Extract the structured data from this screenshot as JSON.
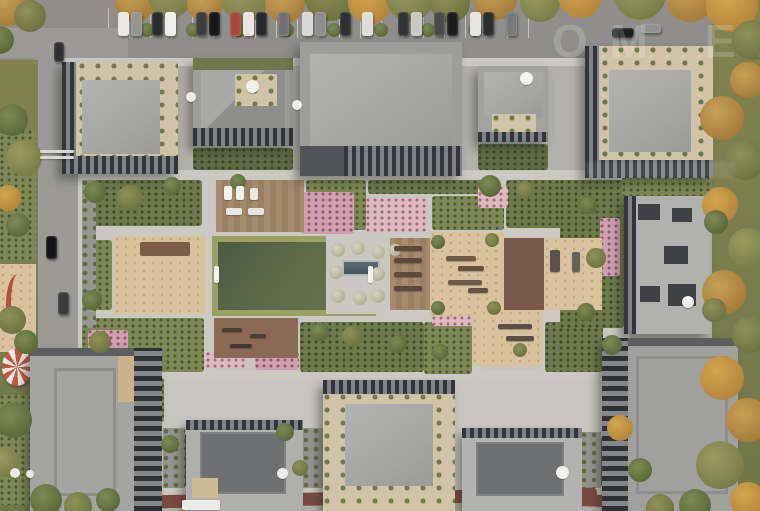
{
  "meta": {
    "subject": "aerial top-down architectural render of a residential complex with landscaped courtyard",
    "watermark_note": "faint translucent site watermark, partially legible"
  },
  "watermark": {
    "line1": "ОМ ЕА"
  },
  "palette": {
    "asphalt": "#8f8e8b",
    "road": "#9b9a97",
    "paving": "#c8c6c0",
    "path": "#cbc9c4",
    "roof_light": "#a8a8a6",
    "roof_dark": "#6e7072",
    "facade_dark": "#33353a",
    "gravel": "#d1c3a7",
    "sand": "#d8c39e",
    "deck": "#a68a6c",
    "rubber": "#7a5b4b",
    "field_green": "#55634a",
    "hedge": "#9aa164",
    "pool_blue": "#4d5d68",
    "track_red": "#7c4a42",
    "play_red": "#c05840",
    "trees": {
      "autumn": [
        "#c9a055",
        "#9a6f33"
      ],
      "autumn2": [
        "#d2a74e",
        "#a87a36"
      ],
      "olive": [
        "#9c9c60",
        "#6f7240"
      ],
      "olive2": [
        "#8f9158",
        "#626a38"
      ],
      "green": [
        "#7d8b52",
        "#4f5d33"
      ],
      "pale": [
        "#d6d2bc",
        "#a9a58c"
      ]
    },
    "beds": {
      "g1": [
        "#6e7a4c",
        "#3f4a2b"
      ],
      "g2": [
        "#7e8955",
        "#4c5631"
      ],
      "g3": [
        "#5a6740",
        "#37422a"
      ],
      "pink": [
        "#cfa0af",
        "#8f5a6b"
      ],
      "pink2": [
        "#ddb9c3",
        "#a06b7a"
      ],
      "hedge": [
        "#5f6b42",
        "#39452a"
      ]
    }
  },
  "scene": {
    "paths": [
      [
        80,
        171,
        548,
        8
      ],
      [
        80,
        225,
        548,
        14
      ],
      [
        80,
        308,
        548,
        13
      ],
      [
        84,
        370,
        540,
        10
      ],
      [
        78,
        171,
        10,
        330
      ],
      [
        202,
        175,
        13,
        200
      ],
      [
        318,
        175,
        12,
        200
      ],
      [
        428,
        175,
        14,
        200
      ],
      [
        540,
        175,
        13,
        200
      ],
      [
        608,
        171,
        14,
        262
      ],
      [
        300,
        308,
        11,
        75
      ],
      [
        470,
        308,
        11,
        75
      ],
      [
        160,
        238,
        9,
        135
      ],
      [
        84,
        480,
        530,
        10
      ],
      [
        62,
        58,
        600,
        8
      ]
    ],
    "beds": [
      [
        84,
        180,
        118,
        46,
        "g1"
      ],
      [
        306,
        180,
        60,
        50,
        "g2"
      ],
      [
        368,
        180,
        118,
        14,
        "g1"
      ],
      [
        432,
        196,
        72,
        34,
        "g2"
      ],
      [
        506,
        180,
        100,
        48,
        "g1"
      ],
      [
        560,
        196,
        44,
        32,
        "pink"
      ],
      [
        366,
        198,
        60,
        34,
        "pink2"
      ],
      [
        300,
        192,
        54,
        42,
        "pink"
      ],
      [
        84,
        240,
        28,
        70,
        "g2"
      ],
      [
        82,
        318,
        122,
        54,
        "g2"
      ],
      [
        300,
        322,
        124,
        50,
        "g1"
      ],
      [
        424,
        322,
        48,
        52,
        "g2"
      ],
      [
        545,
        322,
        58,
        50,
        "g1"
      ],
      [
        600,
        238,
        26,
        78,
        "g2"
      ],
      [
        560,
        180,
        64,
        148,
        "g1"
      ],
      [
        622,
        176,
        90,
        20,
        "g2"
      ],
      [
        163,
        434,
        24,
        52,
        "g3"
      ],
      [
        305,
        434,
        18,
        52,
        "g3"
      ],
      [
        583,
        438,
        20,
        48,
        "g3"
      ],
      [
        84,
        378,
        80,
        44,
        "g2"
      ],
      [
        0,
        130,
        36,
        130,
        "g2"
      ],
      [
        0,
        395,
        30,
        110,
        "g2"
      ],
      [
        255,
        352,
        44,
        18,
        "pink"
      ],
      [
        432,
        316,
        42,
        10,
        "pink2"
      ],
      [
        470,
        278,
        18,
        30,
        "pink"
      ],
      [
        545,
        248,
        16,
        56,
        "pink2"
      ],
      [
        600,
        218,
        20,
        58,
        "pink"
      ],
      [
        308,
        162,
        46,
        12,
        "pink"
      ],
      [
        478,
        186,
        30,
        22,
        "pink2"
      ],
      [
        206,
        352,
        40,
        16,
        "pink2"
      ],
      [
        88,
        330,
        40,
        20,
        "pink"
      ],
      [
        193,
        148,
        100,
        22,
        "hedge"
      ],
      [
        478,
        144,
        70,
        26,
        "hedge"
      ]
    ],
    "walls": [
      [
        82,
        180,
        14,
        148
      ],
      [
        303,
        428,
        20,
        60
      ],
      [
        581,
        432,
        20,
        56
      ],
      [
        163,
        428,
        22,
        60
      ]
    ],
    "trees": [
      [
        135,
        2,
        20,
        "autumn"
      ],
      [
        170,
        -4,
        22,
        "olive"
      ],
      [
        205,
        4,
        18,
        "autumn"
      ],
      [
        245,
        -2,
        24,
        "olive"
      ],
      [
        285,
        3,
        20,
        "autumn"
      ],
      [
        330,
        -5,
        26,
        "olive2"
      ],
      [
        370,
        2,
        22,
        "autumn2"
      ],
      [
        410,
        -3,
        24,
        "olive"
      ],
      [
        450,
        3,
        20,
        "olive2"
      ],
      [
        495,
        -2,
        22,
        "autumn"
      ],
      [
        540,
        2,
        20,
        "olive"
      ],
      [
        580,
        -4,
        22,
        "autumn2"
      ],
      [
        640,
        -6,
        26,
        "olive"
      ],
      [
        690,
        -2,
        24,
        "autumn"
      ],
      [
        732,
        6,
        26,
        "autumn2"
      ],
      [
        752,
        40,
        20,
        "olive2"
      ],
      [
        748,
        80,
        18,
        "autumn"
      ],
      [
        147,
        30,
        7,
        "green"
      ],
      [
        193,
        30,
        7,
        "green"
      ],
      [
        240,
        30,
        7,
        "green"
      ],
      [
        287,
        30,
        7,
        "green"
      ],
      [
        334,
        30,
        7,
        "green"
      ],
      [
        381,
        30,
        7,
        "green"
      ],
      [
        428,
        30,
        7,
        "green"
      ],
      [
        475,
        30,
        7,
        "green"
      ],
      [
        8,
        6,
        20,
        "autumn"
      ],
      [
        30,
        16,
        16,
        "olive2"
      ],
      [
        0,
        40,
        14,
        "green"
      ],
      [
        12,
        120,
        16,
        "green"
      ],
      [
        24,
        158,
        18,
        "olive"
      ],
      [
        8,
        198,
        13,
        "autumn2"
      ],
      [
        18,
        225,
        12,
        "green"
      ],
      [
        12,
        320,
        14,
        "olive2"
      ],
      [
        26,
        342,
        12,
        "green"
      ],
      [
        14,
        420,
        18,
        "green"
      ],
      [
        4,
        462,
        15,
        "olive"
      ],
      [
        46,
        500,
        16,
        "green"
      ],
      [
        78,
        506,
        14,
        "olive2"
      ],
      [
        108,
        500,
        12,
        "green"
      ],
      [
        722,
        118,
        22,
        "autumn"
      ],
      [
        745,
        160,
        20,
        "olive2"
      ],
      [
        720,
        205,
        18,
        "autumn2"
      ],
      [
        748,
        248,
        20,
        "olive"
      ],
      [
        724,
        292,
        22,
        "autumn"
      ],
      [
        750,
        335,
        18,
        "olive2"
      ],
      [
        722,
        378,
        22,
        "autumn2"
      ],
      [
        748,
        420,
        22,
        "autumn"
      ],
      [
        720,
        465,
        24,
        "olive"
      ],
      [
        748,
        500,
        18,
        "autumn2"
      ],
      [
        695,
        505,
        16,
        "green"
      ],
      [
        660,
        508,
        14,
        "olive2"
      ],
      [
        716,
        222,
        12,
        "green"
      ],
      [
        714,
        310,
        12,
        "olive2"
      ],
      [
        95,
        192,
        11,
        "green"
      ],
      [
        130,
        198,
        13,
        "olive2"
      ],
      [
        172,
        186,
        9,
        "green"
      ],
      [
        238,
        182,
        8,
        "green"
      ],
      [
        490,
        186,
        11,
        "green"
      ],
      [
        525,
        190,
        9,
        "olive2"
      ],
      [
        92,
        300,
        10,
        "green"
      ],
      [
        100,
        342,
        11,
        "olive2"
      ],
      [
        320,
        332,
        9,
        "green"
      ],
      [
        352,
        336,
        10,
        "olive2"
      ],
      [
        398,
        344,
        9,
        "green"
      ],
      [
        588,
        205,
        9,
        "green"
      ],
      [
        596,
        258,
        10,
        "olive2"
      ],
      [
        586,
        312,
        9,
        "green"
      ],
      [
        612,
        345,
        10,
        "green"
      ],
      [
        285,
        432,
        9,
        "green"
      ],
      [
        300,
        468,
        8,
        "olive2"
      ],
      [
        170,
        444,
        9,
        "green"
      ],
      [
        620,
        428,
        13,
        "autumn2"
      ],
      [
        640,
        470,
        12,
        "green"
      ],
      [
        440,
        352,
        8,
        "green"
      ],
      [
        520,
        350,
        7,
        "olive2"
      ],
      [
        338,
        250,
        7,
        "pale"
      ],
      [
        358,
        248,
        7,
        "pale"
      ],
      [
        378,
        252,
        7,
        "pale"
      ],
      [
        336,
        272,
        7,
        "pale"
      ],
      [
        378,
        274,
        7,
        "pale"
      ],
      [
        338,
        296,
        7,
        "pale"
      ],
      [
        360,
        298,
        7,
        "pale"
      ],
      [
        378,
        296,
        7,
        "pale"
      ],
      [
        395,
        250,
        6,
        "pale"
      ],
      [
        438,
        242,
        7,
        "green"
      ],
      [
        492,
        240,
        7,
        "olive2"
      ],
      [
        438,
        308,
        7,
        "green"
      ],
      [
        494,
        308,
        7,
        "olive2"
      ]
    ],
    "cars": [
      [
        118,
        12,
        11,
        24,
        "#e9e8e4"
      ],
      [
        131,
        12,
        11,
        24,
        "#95948f"
      ],
      [
        152,
        12,
        11,
        24,
        "#2b2c2e"
      ],
      [
        165,
        12,
        11,
        24,
        "#f0efeb"
      ],
      [
        196,
        12,
        11,
        24,
        "#3c3d3f"
      ],
      [
        209,
        12,
        11,
        24,
        "#151617"
      ],
      [
        230,
        12,
        11,
        24,
        "#a8473d"
      ],
      [
        243,
        12,
        11,
        24,
        "#e7e6e2"
      ],
      [
        256,
        12,
        11,
        24,
        "#27282a"
      ],
      [
        278,
        12,
        11,
        24,
        "#6f7173"
      ],
      [
        302,
        12,
        11,
        24,
        "#d8d7d3"
      ],
      [
        315,
        12,
        11,
        24,
        "#8b8d8f"
      ],
      [
        340,
        12,
        11,
        24,
        "#2e2f31"
      ],
      [
        362,
        12,
        11,
        24,
        "#dededa"
      ],
      [
        398,
        12,
        11,
        24,
        "#313234"
      ],
      [
        411,
        12,
        11,
        24,
        "#c9c8c4"
      ],
      [
        434,
        12,
        11,
        24,
        "#48494b"
      ],
      [
        447,
        12,
        11,
        24,
        "#1a1b1d"
      ],
      [
        470,
        12,
        11,
        24,
        "#e5e4e0"
      ],
      [
        483,
        12,
        11,
        24,
        "#2c2d2f"
      ],
      [
        506,
        12,
        11,
        24,
        "#77797b"
      ],
      [
        612,
        28,
        22,
        10,
        "#1d1e20"
      ],
      [
        641,
        24,
        20,
        9,
        "#8f9193"
      ],
      [
        54,
        42,
        10,
        20,
        "#2f3032"
      ],
      [
        46,
        236,
        11,
        23,
        "#141516"
      ],
      [
        58,
        292,
        11,
        23,
        "#3a3b3d"
      ]
    ],
    "props": [
      [
        246,
        80,
        13,
        13,
        "#f2f1ed",
        1
      ],
      [
        186,
        92,
        10,
        10,
        "#eeede9",
        1
      ],
      [
        292,
        100,
        10,
        10,
        "#eeede9",
        1
      ],
      [
        520,
        72,
        13,
        13,
        "#f3f2ee",
        1
      ],
      [
        682,
        296,
        12,
        12,
        "#f2f1ed",
        1
      ],
      [
        556,
        466,
        13,
        13,
        "#f2f1ed",
        1
      ],
      [
        277,
        468,
        11,
        11,
        "#f0efeb",
        1
      ],
      [
        10,
        468,
        10,
        10,
        "#eceae6",
        1
      ],
      [
        26,
        470,
        8,
        8,
        "#e8e7e3",
        1
      ],
      [
        214,
        266,
        5,
        17,
        "#f5f4f0",
        0
      ],
      [
        368,
        266,
        5,
        17,
        "#f5f4f0",
        0
      ],
      [
        224,
        186,
        8,
        14,
        "#f1f0ec",
        0
      ],
      [
        236,
        186,
        8,
        14,
        "#f1f0ec",
        0
      ],
      [
        250,
        188,
        8,
        12,
        "#eceae6",
        0
      ],
      [
        226,
        208,
        16,
        7,
        "#e8e6e2",
        0
      ],
      [
        248,
        208,
        16,
        7,
        "#e8e6e2",
        0
      ],
      [
        394,
        246,
        28,
        5,
        "#5d4a3a",
        0
      ],
      [
        394,
        258,
        28,
        5,
        "#5d4a3a",
        0
      ],
      [
        394,
        272,
        28,
        5,
        "#5d4a3a",
        0
      ],
      [
        394,
        286,
        28,
        5,
        "#5d4a3a",
        0
      ],
      [
        222,
        328,
        20,
        4,
        "#4a3f35",
        0
      ],
      [
        250,
        334,
        16,
        4,
        "#4a3f35",
        0
      ],
      [
        230,
        344,
        22,
        4,
        "#433931",
        0
      ],
      [
        446,
        256,
        30,
        5,
        "#6f5a46",
        0
      ],
      [
        458,
        266,
        26,
        5,
        "#655240",
        0
      ],
      [
        448,
        280,
        34,
        5,
        "#6f5a46",
        0
      ],
      [
        468,
        288,
        20,
        5,
        "#655240",
        0
      ],
      [
        550,
        250,
        10,
        22,
        "#57544f",
        0
      ],
      [
        572,
        252,
        8,
        20,
        "#64615c",
        0
      ],
      [
        498,
        324,
        34,
        5,
        "#5a5045",
        0
      ],
      [
        506,
        336,
        28,
        5,
        "#5a5045",
        0
      ],
      [
        182,
        500,
        38,
        10,
        "#eceae6",
        0
      ],
      [
        40,
        150,
        34,
        3,
        "#d9d8d4",
        0
      ],
      [
        40,
        156,
        34,
        3,
        "#d9d8d4",
        0
      ]
    ]
  }
}
